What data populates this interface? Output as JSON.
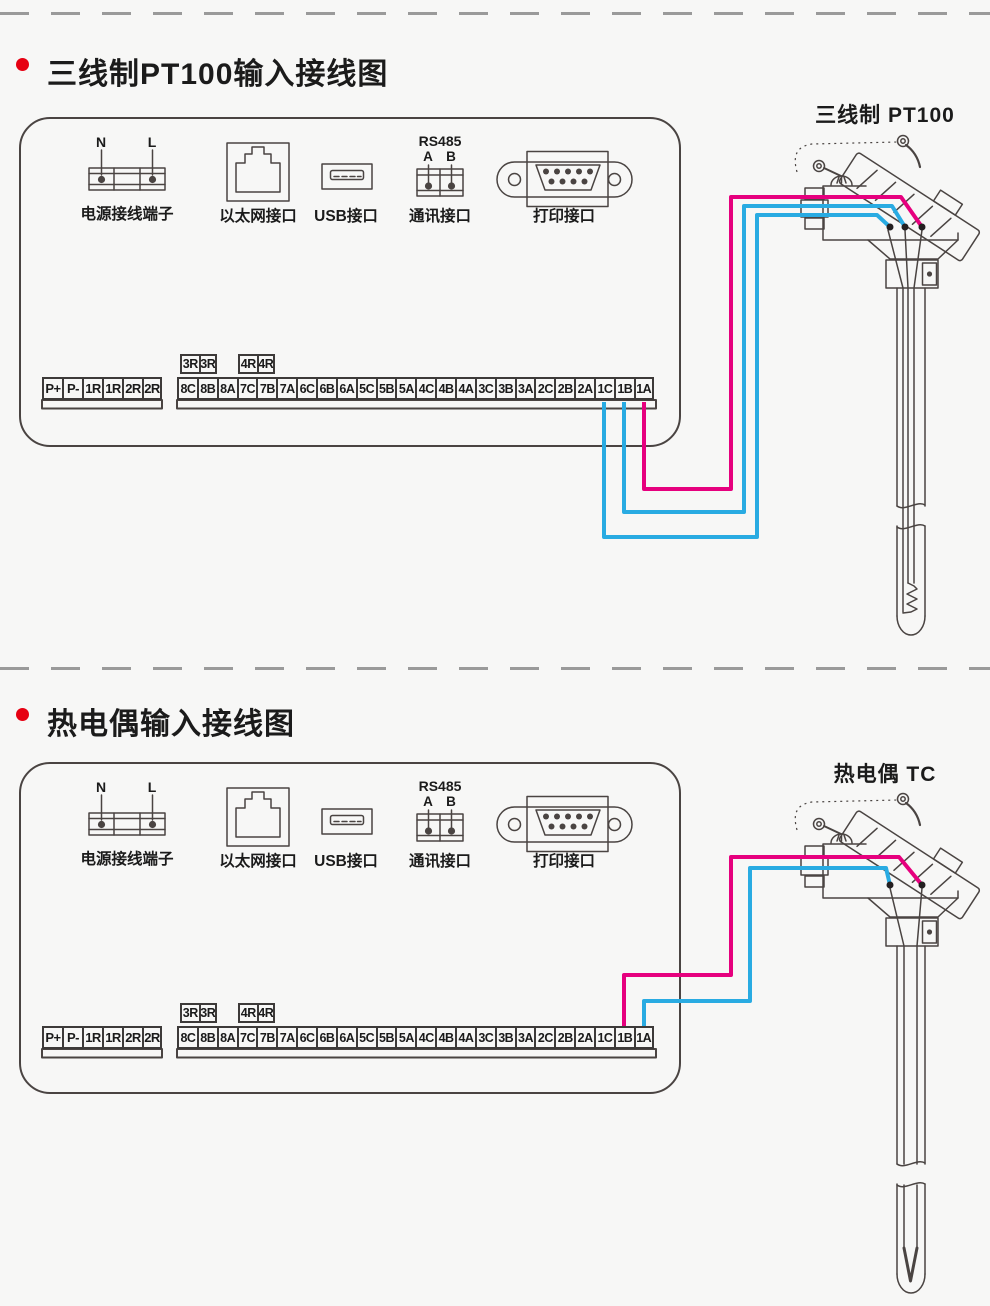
{
  "page": {
    "bg": "#f7f7f6"
  },
  "colors": {
    "wire_magenta": "#e6007e",
    "wire_cyan": "#29abe2",
    "bullet": "#e60012",
    "ink": "#4a4442"
  },
  "sections": [
    {
      "title": "三线制PT100输入接线图",
      "sensor_label": "三线制 PT100",
      "panel": {
        "power": {
          "n": "N",
          "l": "L",
          "label": "电源接线端子"
        },
        "ethernet": {
          "label": "以太网接口"
        },
        "usb": {
          "label": "USB接口"
        },
        "comm": {
          "bus": "RS485",
          "a": "A",
          "b": "B",
          "label": "通讯接口"
        },
        "printer": {
          "label": "打印接口"
        }
      },
      "strip": {
        "left": [
          "P+",
          "P-",
          "1R",
          "1R",
          "2R",
          "2R"
        ],
        "relay_a": [
          "3R",
          "3R"
        ],
        "relay_b": [
          "4R",
          "4R"
        ],
        "main": [
          "8C",
          "8B",
          "8A",
          "7C",
          "7B",
          "7A",
          "6C",
          "6B",
          "6A",
          "5C",
          "5B",
          "5A",
          "4C",
          "4B",
          "4A",
          "3C",
          "3B",
          "3A",
          "2C",
          "2B",
          "2A",
          "1C",
          "1B",
          "1A"
        ]
      }
    },
    {
      "title": "热电偶输入接线图",
      "sensor_label": "热电偶 TC",
      "panel": {
        "power": {
          "n": "N",
          "l": "L",
          "label": "电源接线端子"
        },
        "ethernet": {
          "label": "以太网接口"
        },
        "usb": {
          "label": "USB接口"
        },
        "comm": {
          "bus": "RS485",
          "a": "A",
          "b": "B",
          "label": "通讯接口"
        },
        "printer": {
          "label": "打印接口"
        }
      },
      "strip": {
        "left": [
          "P+",
          "P-",
          "1R",
          "1R",
          "2R",
          "2R"
        ],
        "relay_a": [
          "3R",
          "3R"
        ],
        "relay_b": [
          "4R",
          "4R"
        ],
        "main": [
          "8C",
          "8B",
          "8A",
          "7C",
          "7B",
          "7A",
          "6C",
          "6B",
          "6A",
          "5C",
          "5B",
          "5A",
          "4C",
          "4B",
          "4A",
          "3C",
          "3B",
          "3A",
          "2C",
          "2B",
          "2A",
          "1C",
          "1B",
          "1A"
        ]
      }
    }
  ]
}
